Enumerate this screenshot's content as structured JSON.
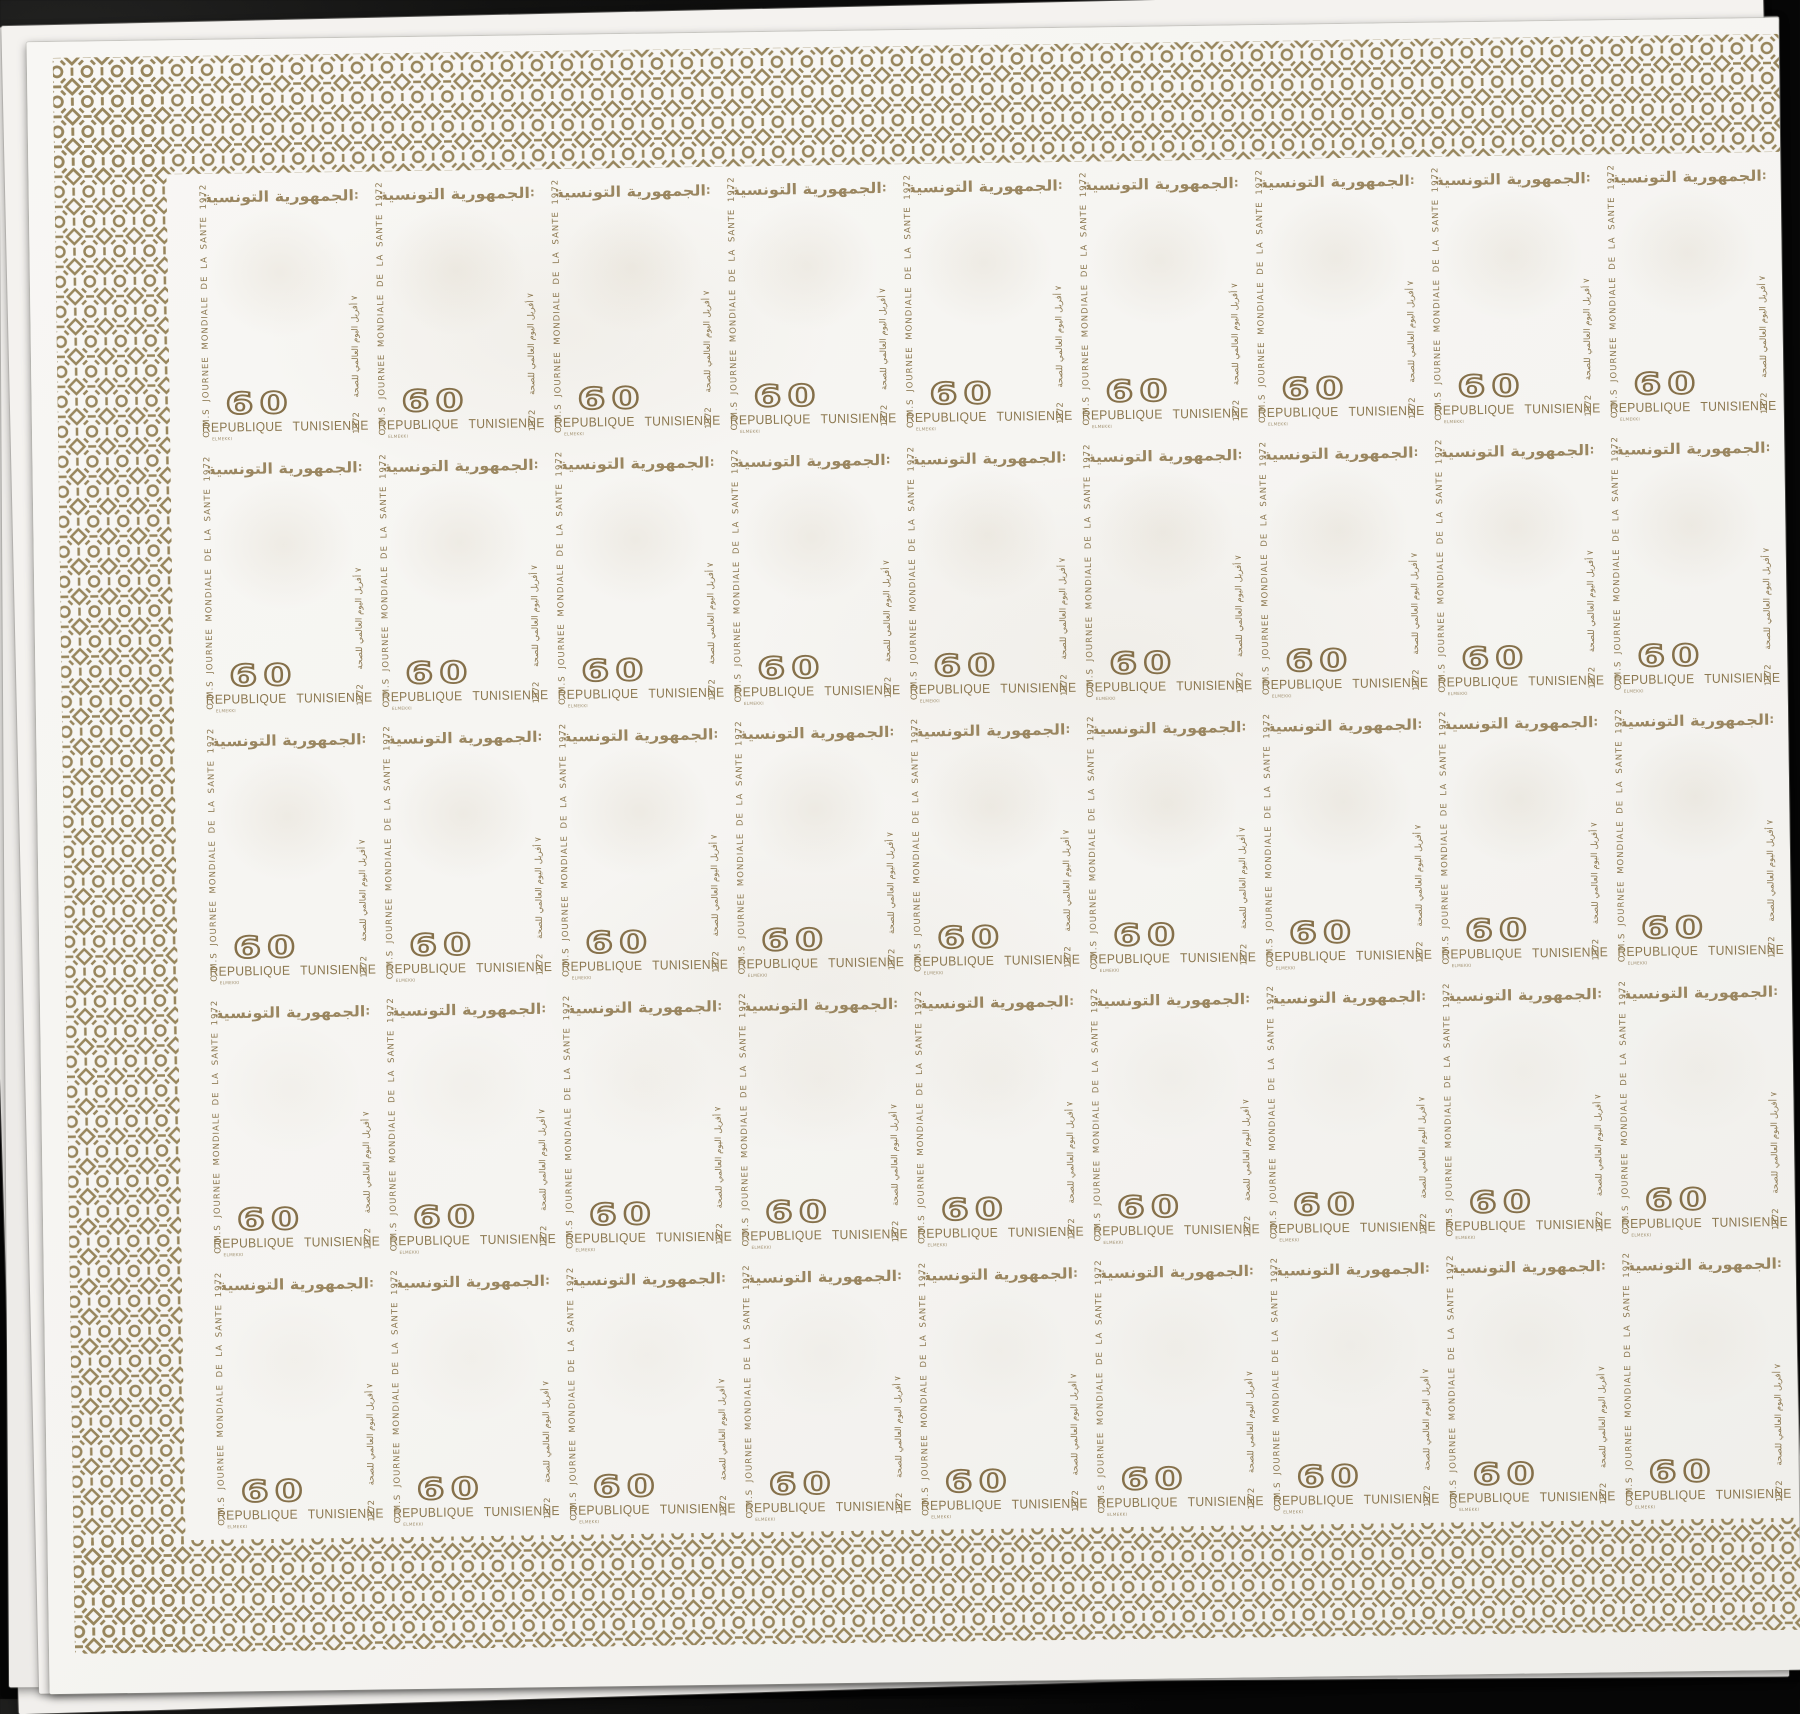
{
  "scene": {
    "description_colors": {
      "background": "#0d0d0d",
      "paper": "#f5f4f1",
      "under_paper": "#efedea",
      "border_ink": "#97855c",
      "text_ink": "#8c7850",
      "value_ink": "#85704a",
      "title_ink": "#9a8660"
    }
  },
  "sheet": {
    "rows": 5,
    "columns": 9,
    "stamp": {
      "arabic_title": "الجمهورية التونسية",
      "title_dots": ":",
      "left_text": "O.M.S JOURNEE MONDIALE DE LA SANTE 1972",
      "right_text_year": "1972",
      "right_text_date": "٧ أفريل",
      "right_text_arabic": "اليوم العالمي للصحة",
      "denomination": "60",
      "country": "REPUBLIQUE TUNISIENNE",
      "artist_mark": "ELMEKKI"
    }
  }
}
